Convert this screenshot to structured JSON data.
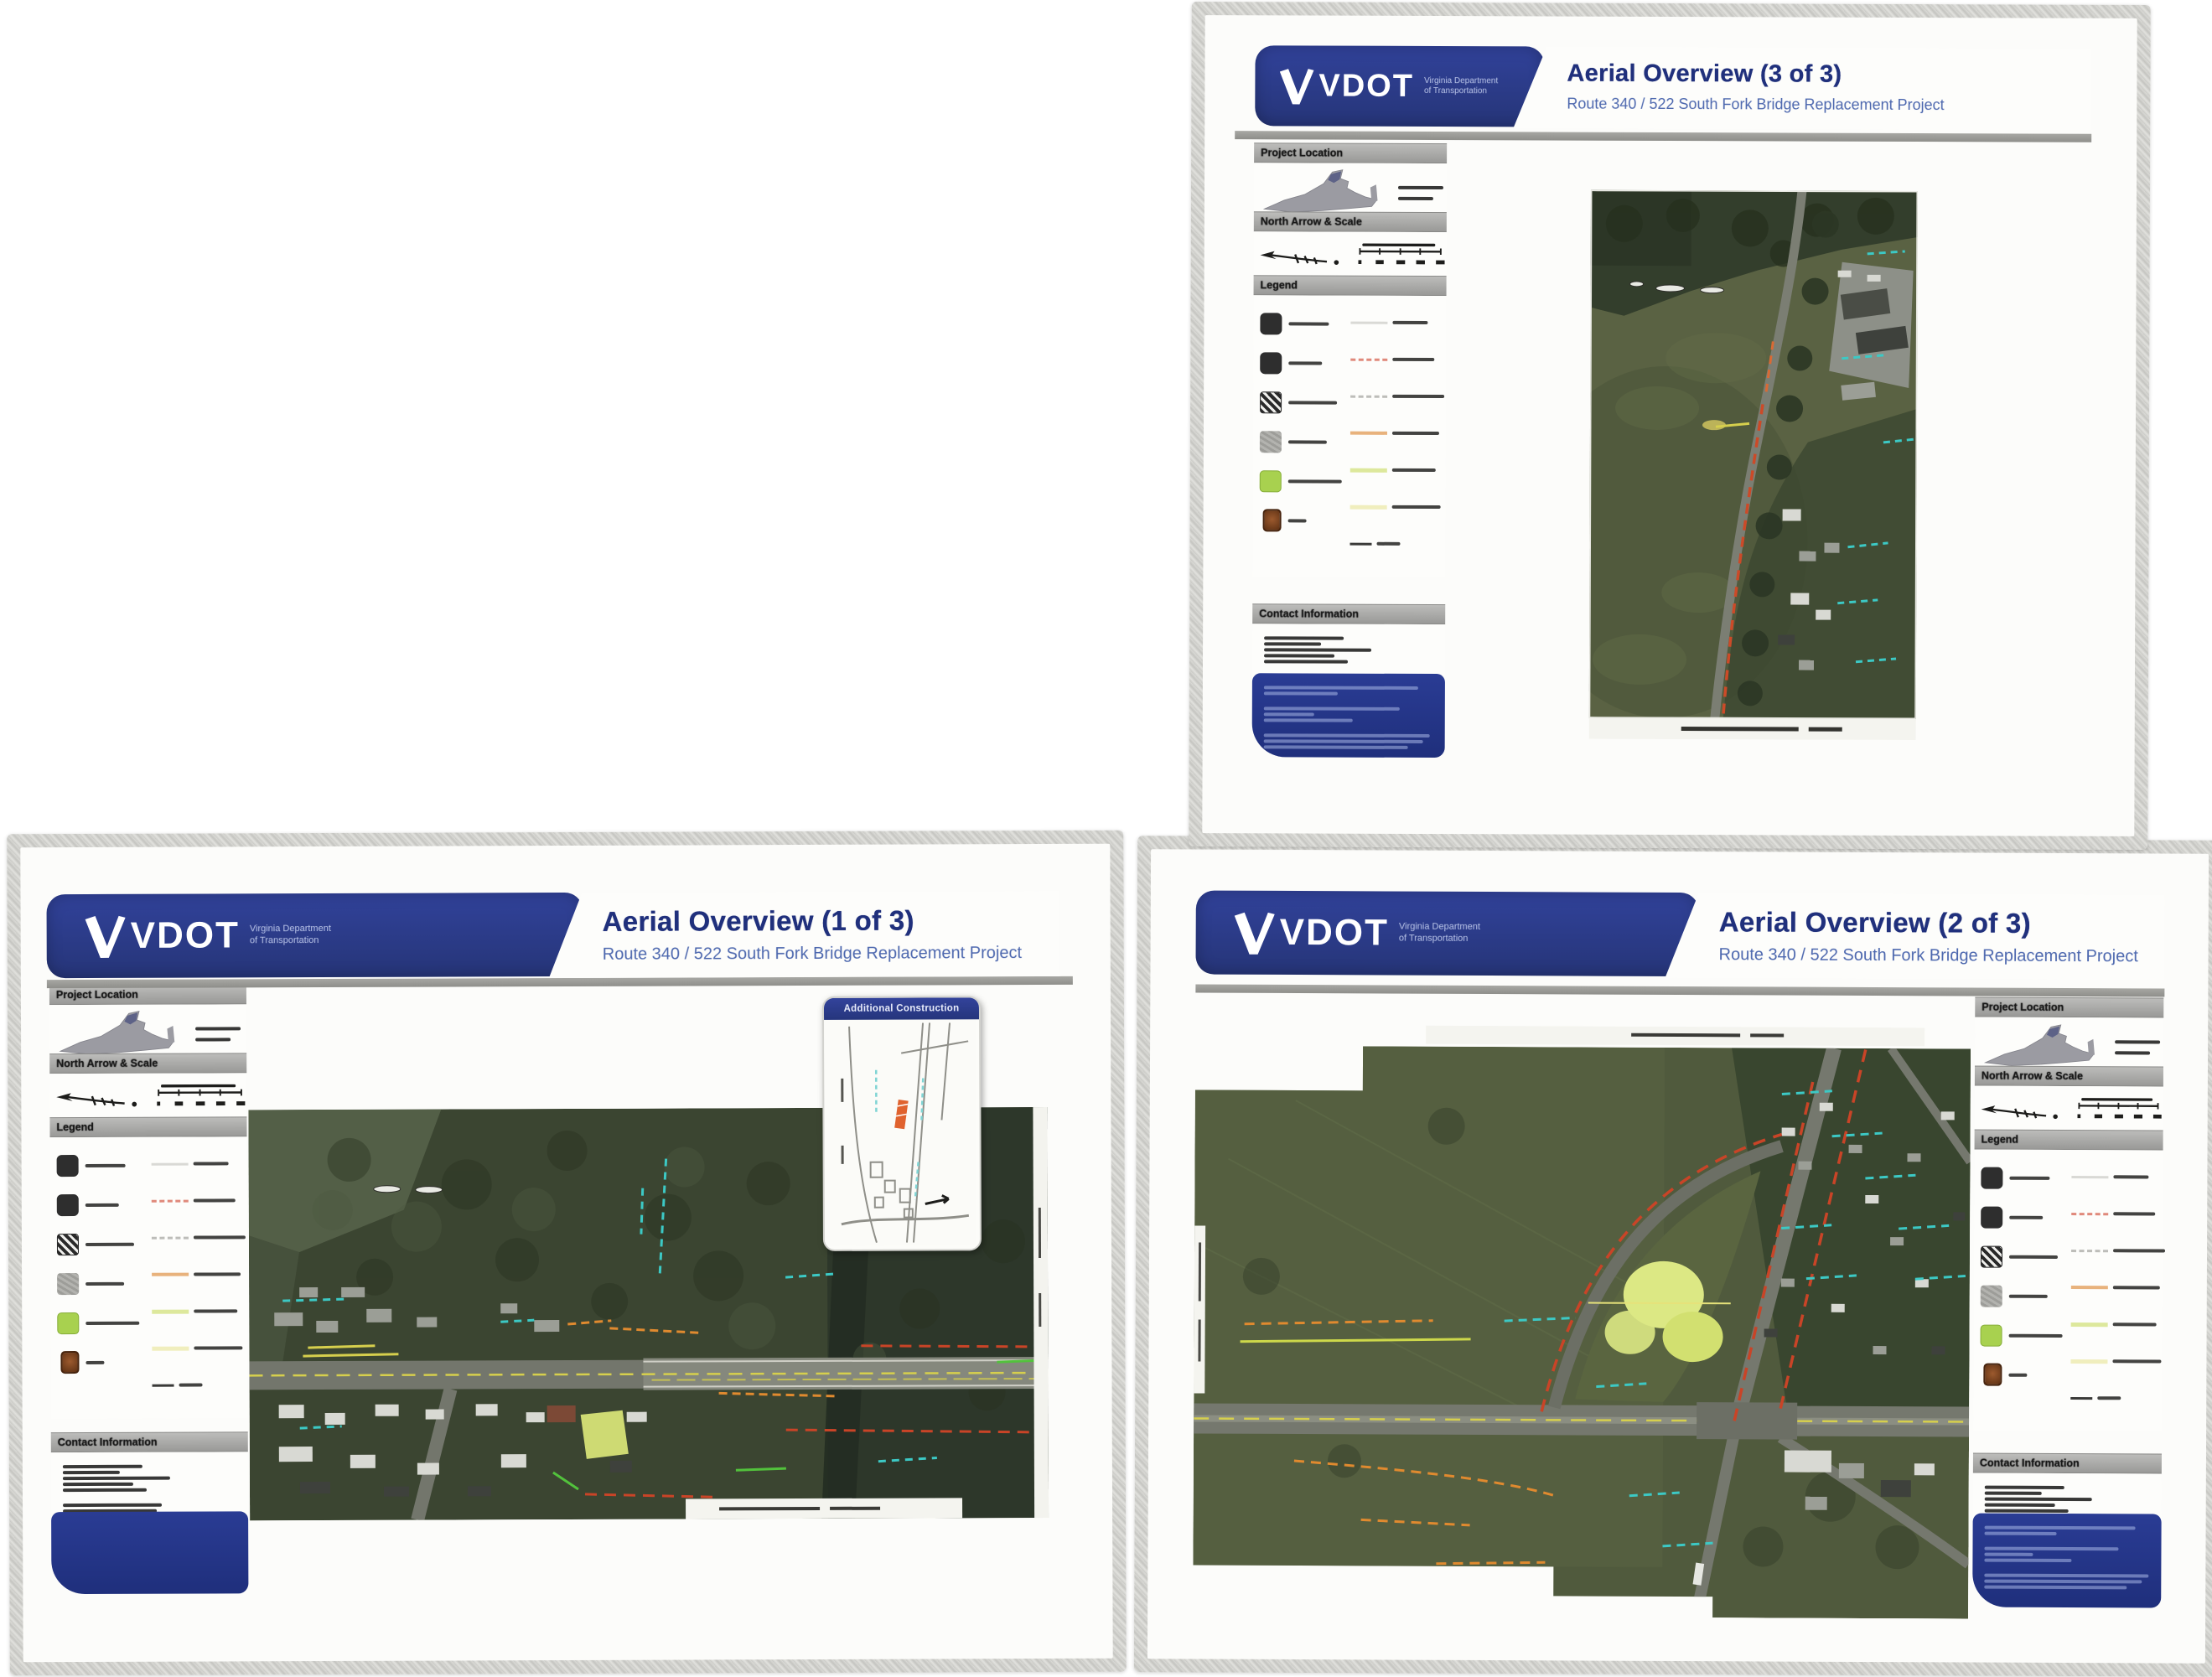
{
  "brand": {
    "logo_text": "VDOT",
    "dept_line1": "Virginia Department",
    "dept_line2": "of Transportation"
  },
  "project_subtitle": "Route 340 / 522 South Fork Bridge Replacement Project",
  "sheets": [
    {
      "title": "Aerial Overview (1 of 3)"
    },
    {
      "title": "Aerial Overview (2 of 3)"
    },
    {
      "title": "Aerial Overview (3 of 3)"
    }
  ],
  "sidebar_labels": {
    "project_location": "Project Location",
    "north_arrow_scale": "North Arrow & Scale",
    "legend": "Legend",
    "contact_information": "Contact Information"
  },
  "inset_title": "Additional Construction",
  "legend": {
    "swatches": [
      {
        "name": "dark-solid-swatch",
        "color": "#2e2e2e"
      },
      {
        "name": "dark-solid-swatch-2",
        "color": "#2e2e2e"
      },
      {
        "name": "hatched-swatch",
        "color": "#292929"
      },
      {
        "name": "gray-textured-swatch",
        "color": "#a8a8a4"
      },
      {
        "name": "green-swatch",
        "color": "#a8d14f"
      },
      {
        "name": "brown-emblem-swatch",
        "color": "#7a4420"
      }
    ],
    "lines": [
      {
        "name": "faint-gray-line",
        "color": "#d9d9d5",
        "style": "solid"
      },
      {
        "name": "red-dashed-line",
        "color": "#e0897b",
        "style": "dashed"
      },
      {
        "name": "gray-dashed-line",
        "color": "#bdbdb9",
        "style": "dashed"
      },
      {
        "name": "orange-line",
        "color": "#e8b27c",
        "style": "solid"
      },
      {
        "name": "yellow-green-line",
        "color": "#dde89c",
        "style": "solid"
      },
      {
        "name": "pale-yellow-line",
        "color": "#f0eebd",
        "style": "solid"
      },
      {
        "name": "dark-line",
        "color": "#3a3a38",
        "style": "solid"
      }
    ]
  },
  "colors": {
    "banner_blue": "#2c3d8f",
    "title_blue": "#20307c",
    "subtitle_blue": "#4c67ae",
    "section_bar_gray": "#a5a5a3",
    "contact_block_blue": "#24358b",
    "virginia_map_gray": "#9b9ba2",
    "aerial_field_green": "#55603f",
    "aerial_forest_green": "#333e2c",
    "road_gray": "#75786e",
    "annotation_red": "#c94427",
    "annotation_orange": "#e08a2f",
    "annotation_yellow": "#d6cf4d",
    "annotation_teal": "#3cc9c5",
    "annotation_green": "#52c23c",
    "highlight_yellow_green": "#d6e377"
  }
}
